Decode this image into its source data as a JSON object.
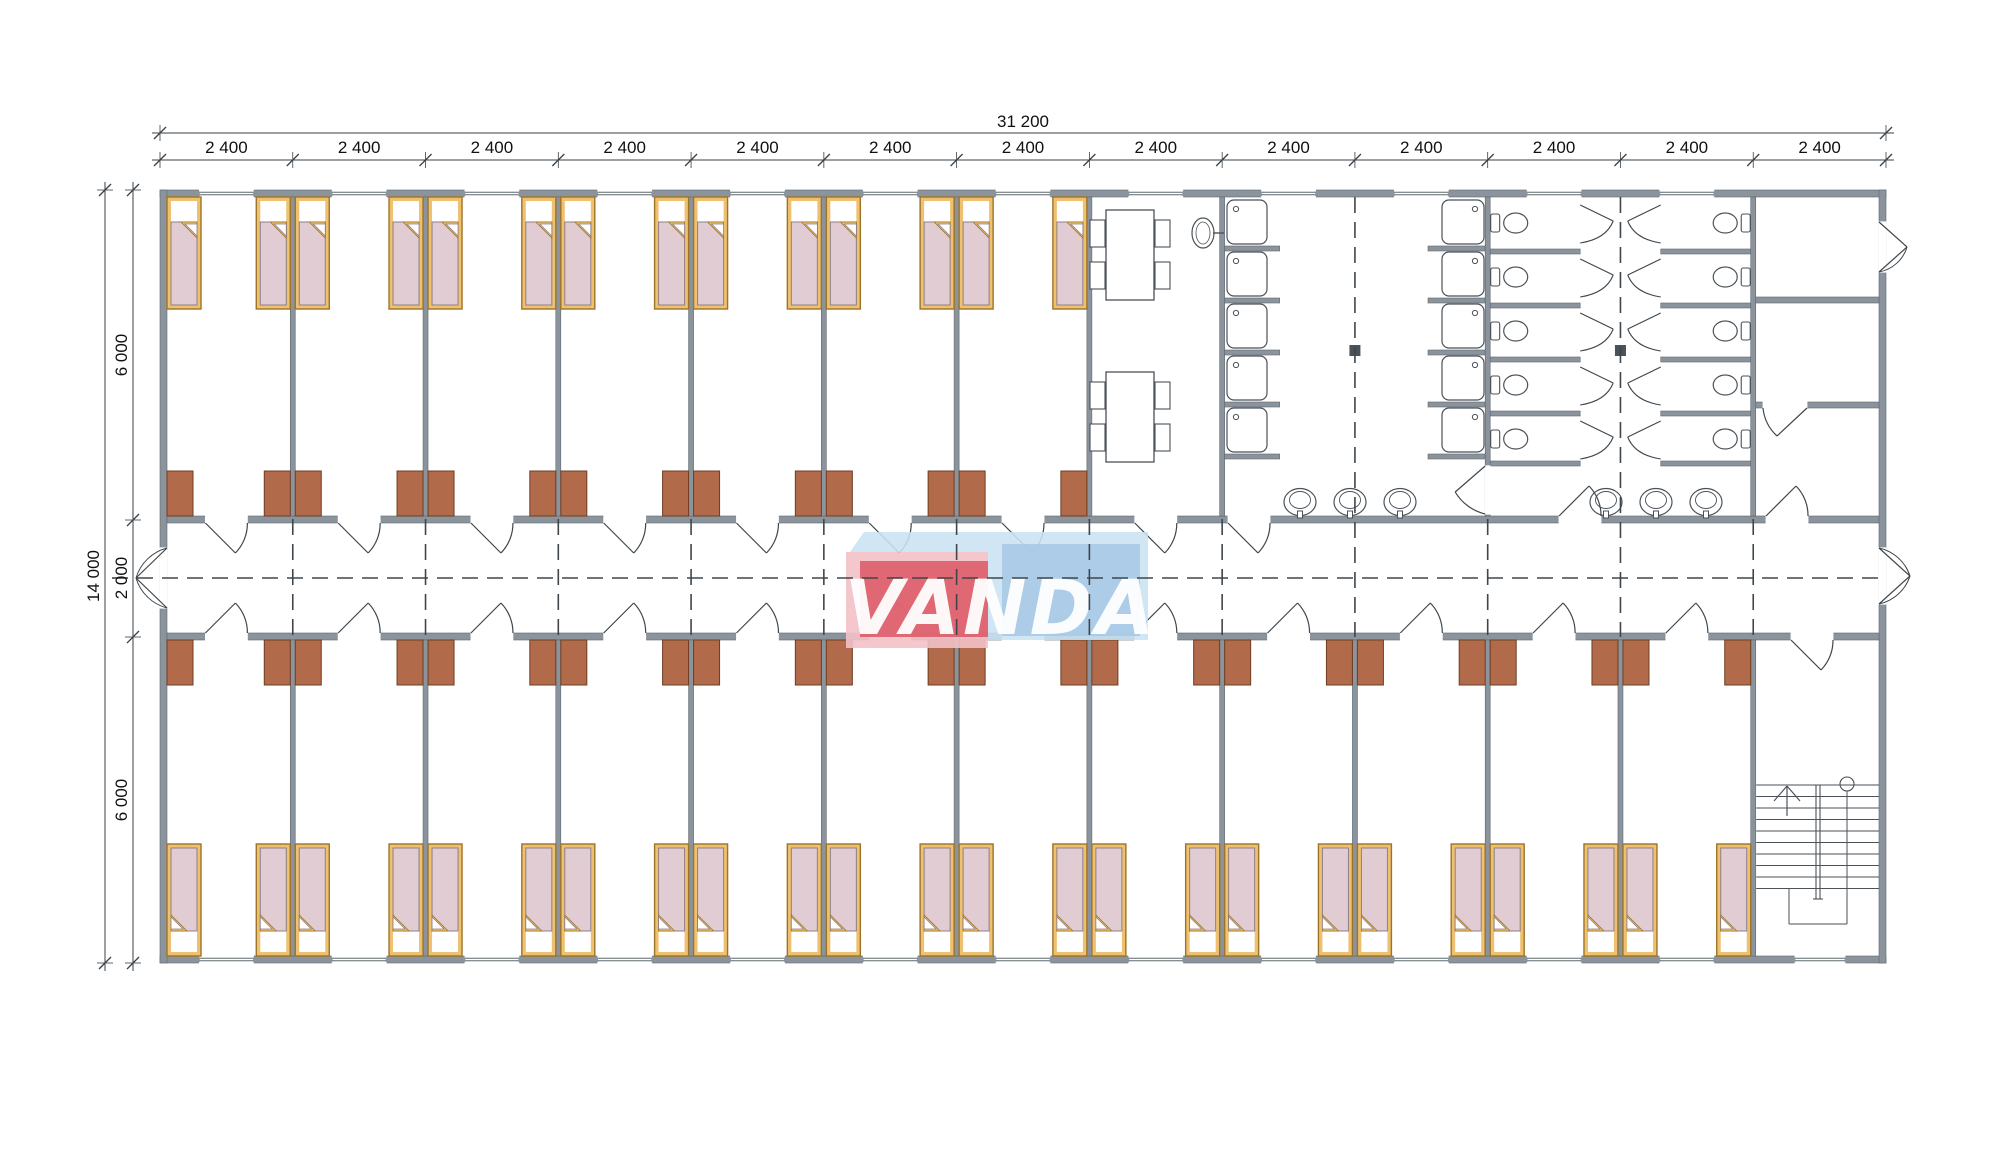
{
  "watermark": {
    "text": "VANDA"
  },
  "dimensions": {
    "top_total": "31 200",
    "top_segments": [
      "2 400",
      "2 400",
      "2 400",
      "2 400",
      "2 400",
      "2 400",
      "2 400",
      "2 400",
      "2 400",
      "2 400",
      "2 400",
      "2 400",
      "2 400"
    ],
    "left_total": "14 000",
    "left_segments": [
      "6 000",
      "2 000",
      "6 000"
    ]
  },
  "plan": {
    "type": "dormitory-floor-plan",
    "modules": 13,
    "module_width_mm": 2400,
    "total_width_mm": 31200,
    "total_depth_mm": 14000,
    "corridor_depth_mm": 2000,
    "room_depth_mm": 6000,
    "top_bedroom_modules": 7,
    "bottom_bedroom_modules": 12
  },
  "inventory": {
    "beds": 38,
    "wardrobes": 38,
    "shower_trays": 10,
    "toilets": 10,
    "washbasins": 6,
    "dining_tables": 2,
    "chairs": 8,
    "drinking_fountain": 1,
    "staircases": 1
  },
  "colors": {
    "wall": "#8b949c",
    "wall_stroke": "#5f686f",
    "wardrobe": "#b16a4a",
    "wardrobe_stroke": "#6f3d22",
    "bed_frame": "#eec06f",
    "bed_frame_stroke": "#9c7428",
    "mattress": "#e1ccd4",
    "mattress_stroke": "#8d7f88",
    "fixture_line": "#4a5258",
    "dash_line": "#3e464c",
    "dim_line": "#3a4146",
    "text": "#111111",
    "wm_pink": "#f3c1c8",
    "wm_red": "#dc5260",
    "wm_blue_light": "#c9e2f3",
    "wm_blue": "#a7c9e7",
    "wm_text": "#ffffff"
  }
}
